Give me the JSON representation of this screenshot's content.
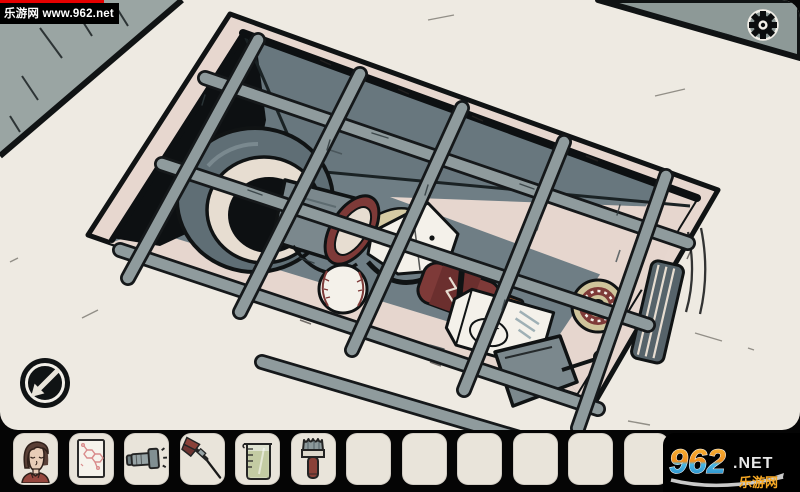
{
  "watermark_top": {
    "text": "乐游网 www.962.net",
    "bar_color": "#e60000"
  },
  "logo_badge": {
    "number": "962",
    "domain": ".NET",
    "site_name": "乐游网"
  },
  "scene": {
    "description": "top-down cartoon view of a floor drain pit covered by a metal grate, trash inside",
    "milk_label": "MILK",
    "objects": [
      "drain-pit",
      "metal-grate",
      "drain-pipe",
      "bucket",
      "baseball",
      "crumpled-paper",
      "ketchup-bottle",
      "milk-carton",
      "dustpan",
      "tape-roll",
      "rolled-magazine",
      "banana-peel"
    ],
    "buttons": {
      "back": "back-arrow-icon",
      "settings": "gear-icon"
    }
  },
  "inventory": {
    "slot_count": 14,
    "filled_count": 6,
    "items": [
      "portrait-photo",
      "molecule-note",
      "flashlight",
      "dart",
      "measuring-cup",
      "paint-brush",
      null,
      null,
      null,
      null,
      null,
      null,
      null,
      null
    ]
  },
  "palette": {
    "floor_cream": "#eeeae2",
    "rim_pink": "#e7d7cf",
    "wall_slate": "#68777e",
    "floor_slate": "#6f7e85",
    "lit_wall": "#e6d6ce",
    "bar_gray": "#8f9b9d",
    "outline_black": "#101314",
    "deep_shadow": "#0d1012",
    "maroon": "#7e3a38",
    "slot_bg": "#e9e4da",
    "logo_orange": "#f7a823",
    "logo_blue": "#2f9fd0"
  }
}
